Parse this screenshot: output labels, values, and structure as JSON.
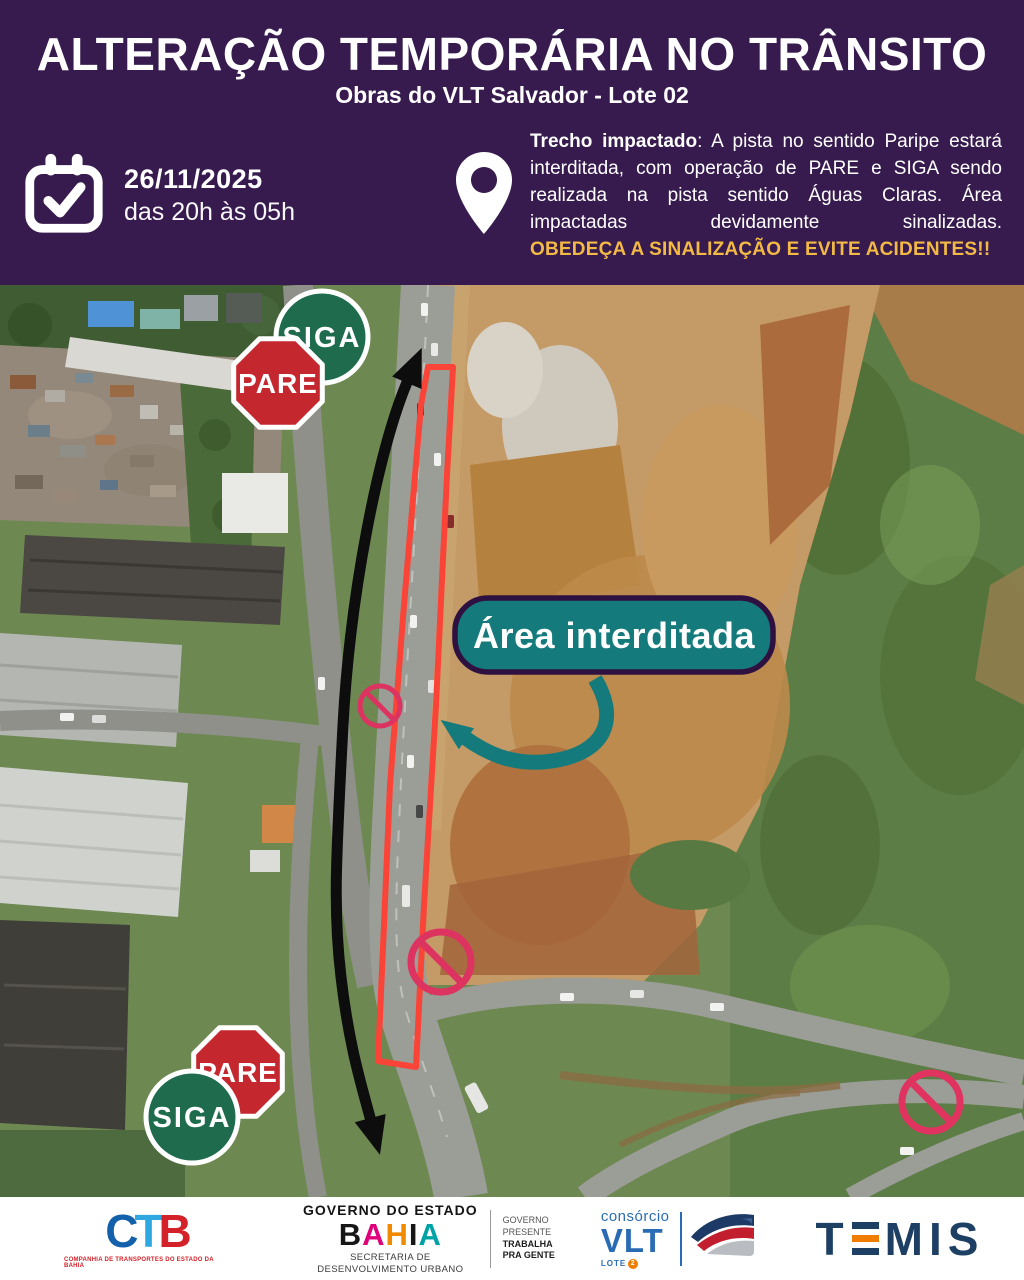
{
  "header": {
    "title": "ALTERAÇÃO TEMPORÁRIA NO TRÂNSITO",
    "subtitle": "Obras do VLT Salvador - Lote 02"
  },
  "schedule": {
    "date": "26/11/2025",
    "time": "das 20h às 05h"
  },
  "notice": {
    "lead": "Trecho impactado",
    "body": ": A pista no sentido Paripe estará interditada, com operação de PARE e SIGA sendo realizada na pista sentido Águas Claras. Área impactadas devidamente sinalizadas.",
    "warning": "OBEDEÇA A SINALIZAÇÃO E EVITE ACIDENTES!!"
  },
  "map": {
    "area_label": "Área interditada",
    "signs": {
      "pare": "PARE",
      "siga": "SIGA"
    }
  },
  "footer": {
    "ctb": {
      "letters": [
        "C",
        "T",
        "B"
      ],
      "caption": "COMPANHIA DE TRANSPORTES DO ESTADO DA BAHIA"
    },
    "bahia": {
      "heading": "GOVERNO DO ESTADO",
      "letters": [
        "B",
        "A",
        "H",
        "I",
        "A"
      ],
      "sub1": "SECRETARIA DE",
      "sub2": "DESENVOLVIMENTO URBANO",
      "side": [
        "GOVERNO",
        "PRESENTE",
        "TRABALHA",
        "PRA GENTE"
      ]
    },
    "vlt": {
      "top": "consórcio",
      "word": "VLT",
      "lote": "LOTE",
      "lote_badge": "2"
    },
    "temis": {
      "word": "TEMIS",
      "l1": "T",
      "l2": "M",
      "l3": "I",
      "l4": "S"
    }
  },
  "icons": [
    "calendar-check-icon",
    "location-pin-icon",
    "no-entry-icon",
    "train-icon"
  ],
  "colors": {
    "header_purple": "#371b4e",
    "accent_yellow": "#f2b944",
    "label_teal": "#157a7c",
    "label_border_purple": "#2e1140",
    "closed_area_red": "#fa4438",
    "prohibition_pink": "#dc3360",
    "pare_red": "#c4272d",
    "siga_green": "#1e6b4e",
    "temis_navy": "#1d3f63",
    "temis_orange": "#f07c00",
    "vlt_blue": "#2a6cb4",
    "ctb_red": "#d3222a"
  }
}
